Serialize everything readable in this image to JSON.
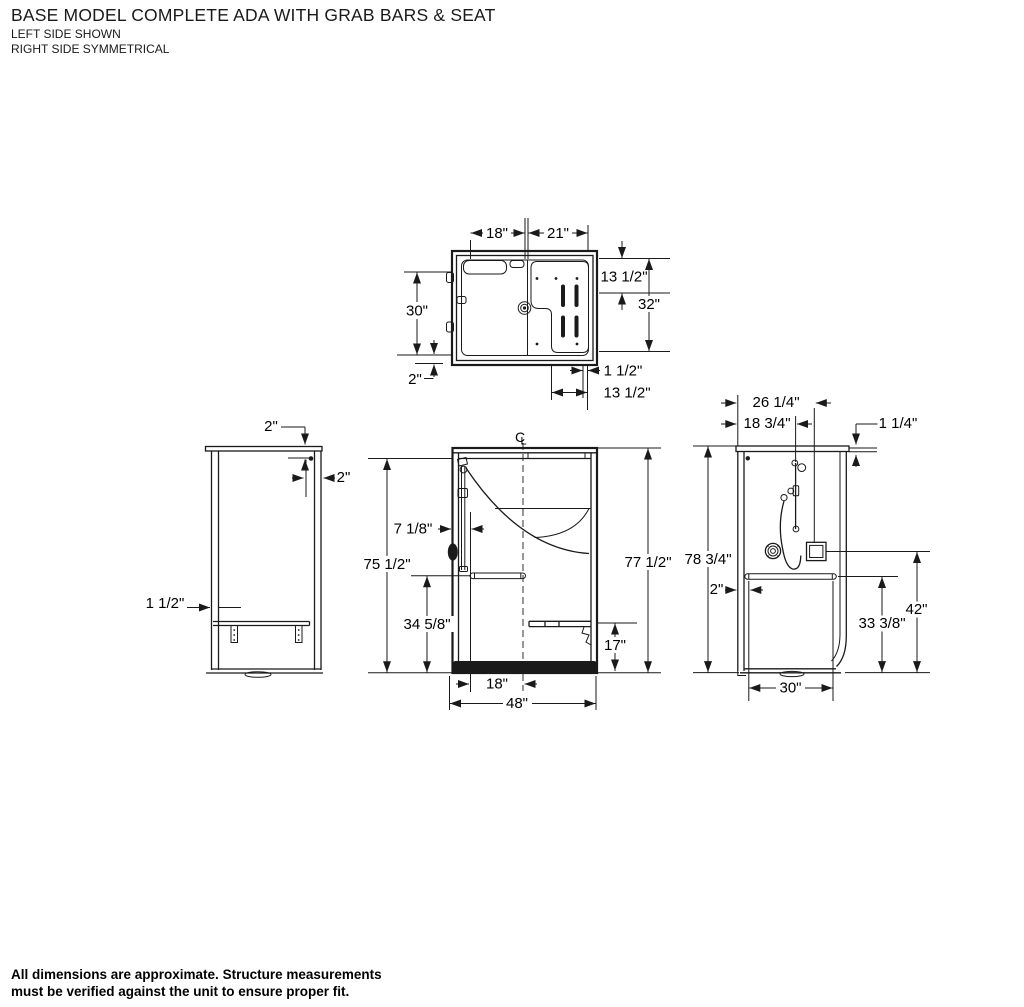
{
  "title": {
    "line1": "BASE MODEL COMPLETE ADA WITH GRAB BARS & SEAT",
    "line2": "LEFT SIDE SHOWN",
    "line3": "RIGHT SIDE SYMMETRICAL"
  },
  "note": {
    "line1": "All dimensions are approximate. Structure measurements",
    "line2": "must be verified against the unit to ensure proper fit."
  },
  "plan_view": {
    "dims": {
      "seat_width": "18\"",
      "entry_width": "21\"",
      "bar_offset_depth": "13 1/2\"",
      "inside_depth": "32\"",
      "left_depth": "30\"",
      "threshold": "2\"",
      "wall_offset": "1 1/2\"",
      "bar_panel_width": "13 1/2\""
    }
  },
  "left_view": {
    "dims": {
      "bar_from_top": "2\"",
      "bar_from_wall": "2\"",
      "wall_thickness": "1 1/2\""
    }
  },
  "front_view": {
    "centerline": {
      "c": "C",
      "l": "L"
    },
    "dims": {
      "head_offset": "7 1/8\"",
      "inside_height": "75 1/2\"",
      "bar_height": "34 5/8\"",
      "seat_height": "17\"",
      "seat_center": "18\"",
      "overall_width": "48\"",
      "overall_height": "77 1/2\""
    }
  },
  "right_view": {
    "dims": {
      "valve_box_offset": "26 1/4\"",
      "slide_bar_offset": "18 3/4\"",
      "flange": "1 1/4\"",
      "overall_height": "78 3/4\"",
      "bar_wall_gap": "2\"",
      "bar_length": "30\"",
      "bar_height": "33 3/8\"",
      "box_height": "42\""
    }
  }
}
